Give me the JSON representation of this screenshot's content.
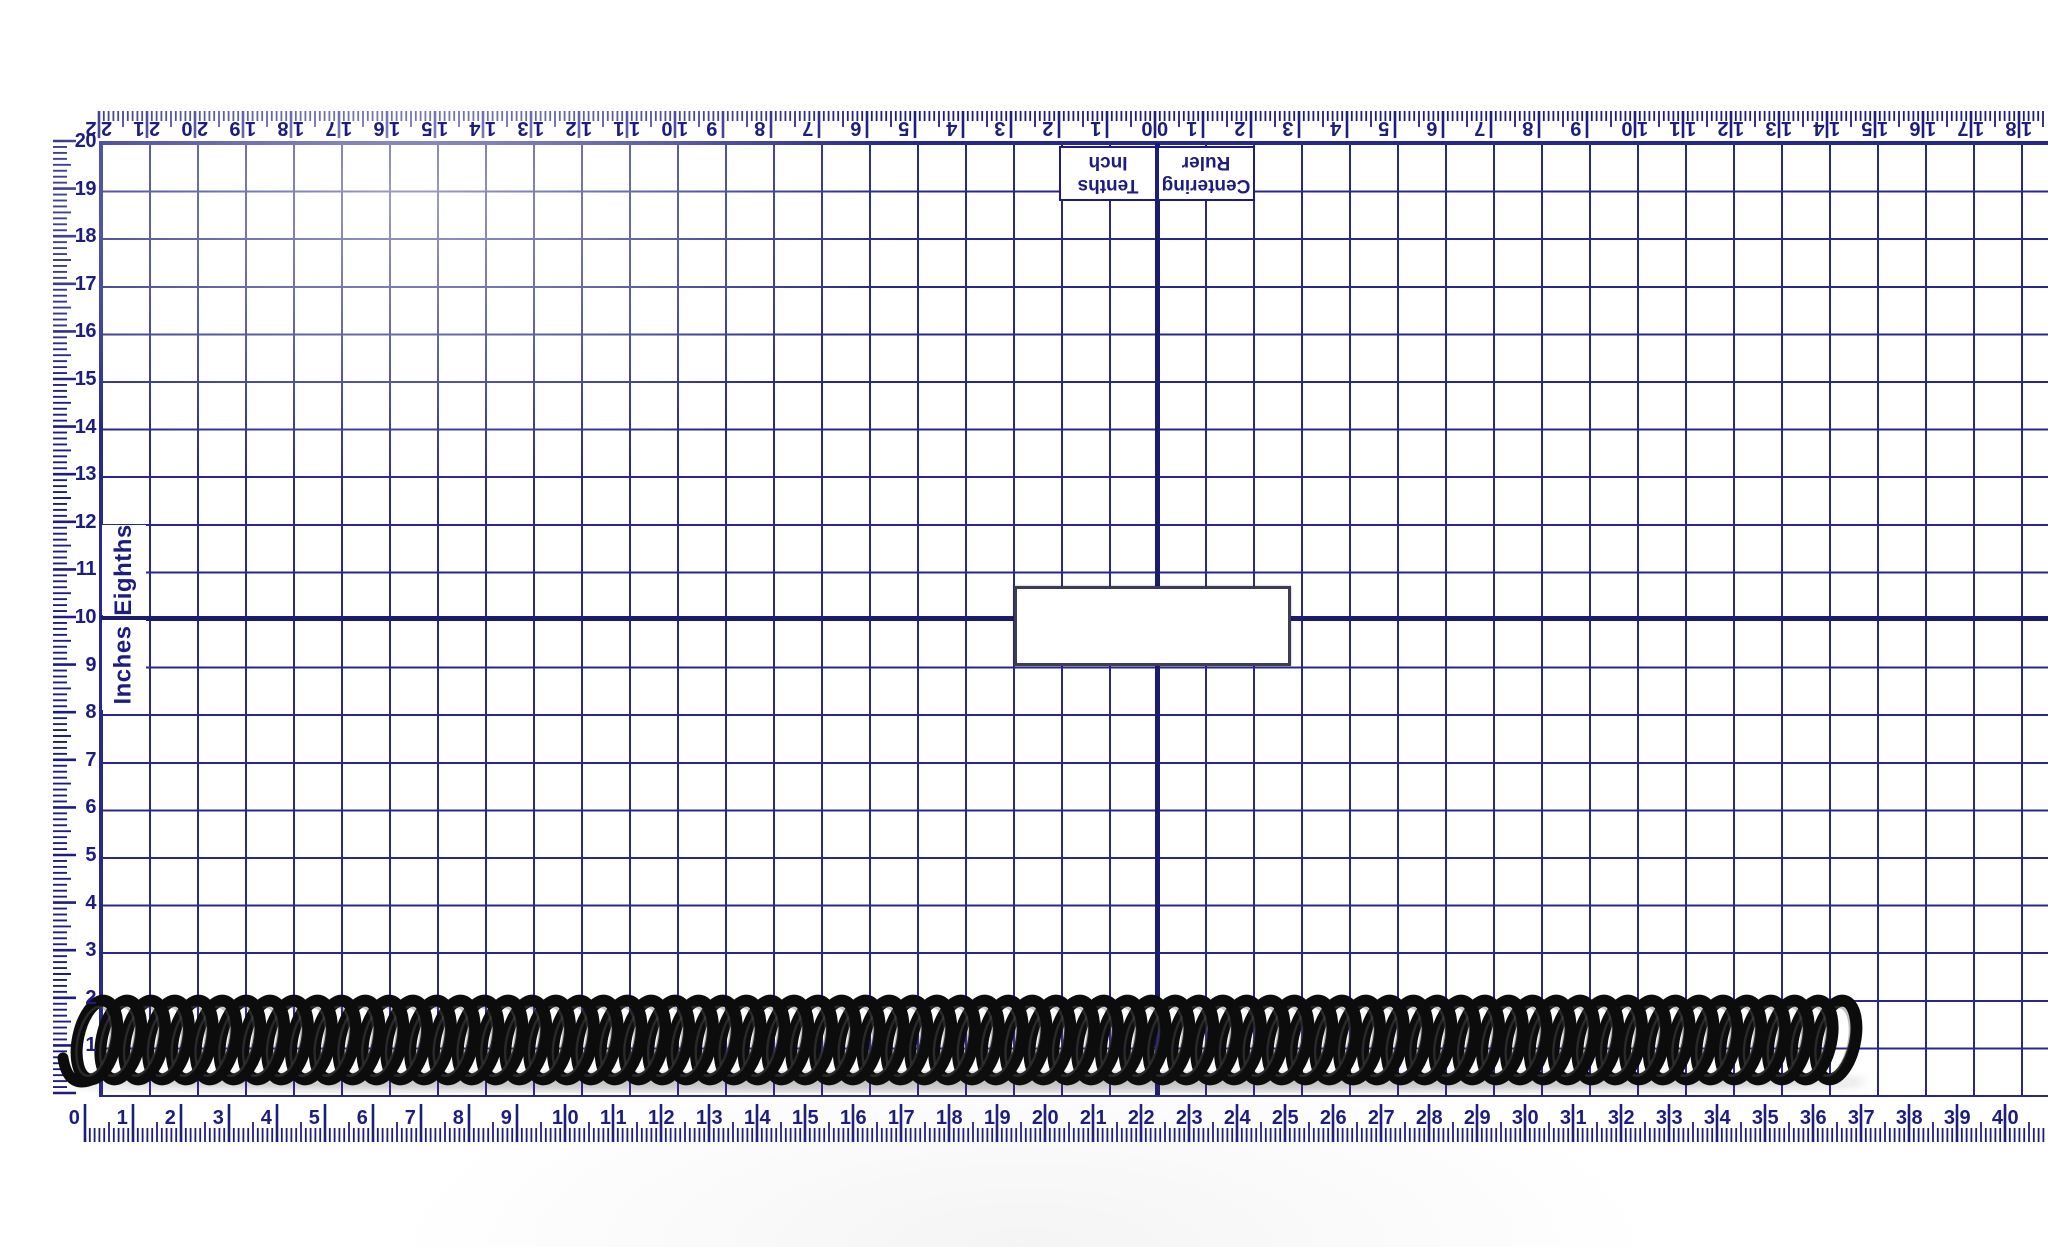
{
  "colors": {
    "line": "#28288c",
    "heavy_line": "#1c1c6e",
    "text": "#1d1d80",
    "spring": "#0c0c0c",
    "spring_highlight": "#5a5a5a"
  },
  "ruler_card": {
    "top_ruler": {
      "title_line1": "Centering",
      "title_line2": "Ruler",
      "unit_line1": "Tenths",
      "unit_line2": "Inch",
      "center_label": "0|0",
      "labels_left": [
        "2|2",
        "2|1",
        "2|0",
        "1|9",
        "1|8",
        "1|7",
        "1|6",
        "1|5",
        "1|4",
        "1|3",
        "1|2",
        "1|1",
        "1|0",
        "9",
        "8",
        "7",
        "6",
        "5",
        "4",
        "3",
        "2",
        "1"
      ],
      "labels_right": [
        "1",
        "2",
        "3",
        "4",
        "5",
        "6",
        "7",
        "8",
        "9",
        "1|0",
        "1|1",
        "1|2",
        "1|3",
        "1|4",
        "1|5",
        "1|6",
        "1|7",
        "1|8"
      ]
    },
    "left_ruler": {
      "labels": [
        "20",
        "19",
        "18",
        "17",
        "16",
        "15",
        "14",
        "13",
        "12",
        "11",
        "10",
        "9",
        "8",
        "7",
        "6",
        "5",
        "4",
        "3",
        "2",
        "1"
      ],
      "section_label_upper": "Eighths",
      "section_label_lower": "Inches"
    },
    "bottom_ruler": {
      "labels": [
        "0",
        "1",
        "2",
        "3",
        "4",
        "5",
        "6",
        "7",
        "8",
        "9",
        "1|0",
        "1|1",
        "1|2",
        "1|3",
        "1|4",
        "1|5",
        "1|6",
        "1|7",
        "1|8",
        "1|9",
        "2|0",
        "2|1",
        "2|2",
        "2|3",
        "2|4",
        "2|5",
        "2|6",
        "2|7",
        "2|8",
        "2|9",
        "3|0",
        "3|1",
        "3|2",
        "3|3",
        "3|4",
        "3|5",
        "3|6",
        "3|7",
        "3|8",
        "3|9",
        "4|0"
      ]
    },
    "blank_box_text": ""
  },
  "spring": {
    "start_inch": 0.0,
    "end_inch": 3.7,
    "outer_diameter_inch": 0.18,
    "turns": 74
  }
}
